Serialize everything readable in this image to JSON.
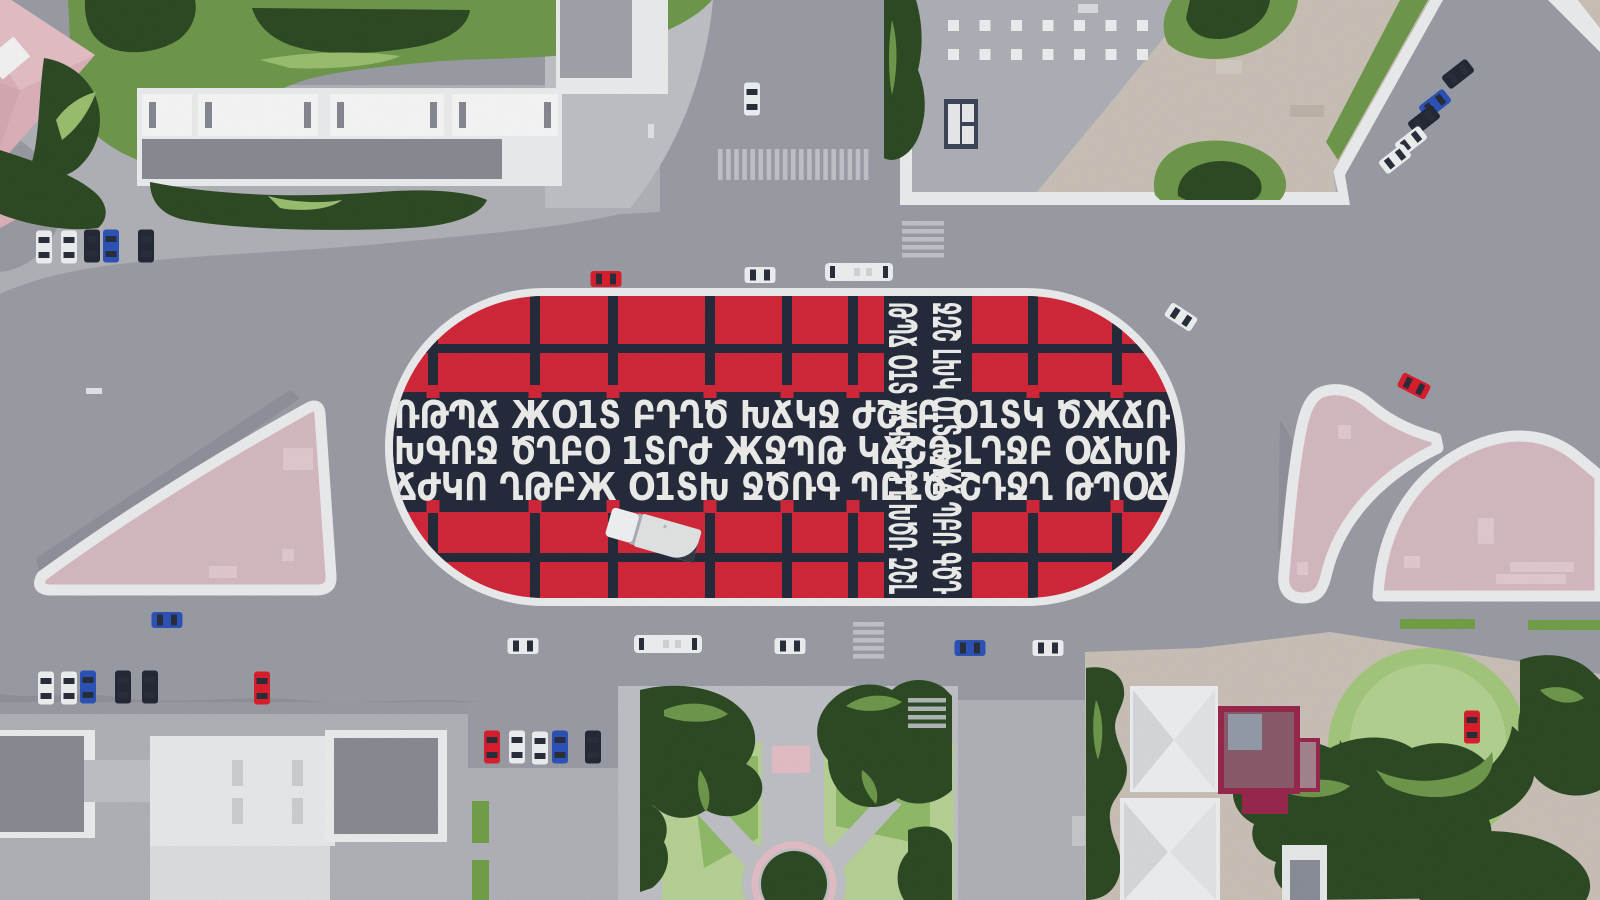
{
  "palette": {
    "road": "#9fa1aa",
    "sidewalk": "#b5b7bd",
    "pave": "#c4c6cb",
    "paveBright": "#dfe1e4",
    "shadow": "#8b8d96",
    "white": "#f2f3f4",
    "whiteBright": "#fafbfb",
    "roofGray": "#8d8f98",
    "roofLightGray": "#b3b5bc",
    "beige": "#cfc6bc",
    "tan": "#c8b9a9",
    "pinkRoof": "#e2b6bf",
    "pinkRoofLight": "#ecc7cd",
    "pinkRoofDark": "#d8a8b2",
    "pinkPlaza": "#dbbfc6",
    "pinkPatch": "#e7d0d5",
    "plazaRed": "#d7293c",
    "plazaNavy": "#272d3e",
    "glyph": "#f4f4f2",
    "greenDark": "#2f4d26",
    "greenMid": "#729c4e",
    "greenLight": "#9ec573",
    "lawn": "#bcd79a",
    "grassStrip": "#76a44c",
    "maroon": "#9c2950",
    "maroonInner": "#8e6370",
    "glassFrame": "#40475a",
    "skylightGray": "#97a0ad",
    "carWhite": "#f5f6f7",
    "carBlack": "#262b39",
    "carBlue": "#2f55bd",
    "carRed": "#e0202e",
    "carWindow": "#2b303d",
    "crosswalk": "#cdcfd4",
    "truckBody": "#e8ebeb",
    "truckCab": "#f7f8f9",
    "truckShadow": "#363b47"
  },
  "plaza": {
    "glyph_rows": [
      "ՌԹՊՃ ЖՕ1Տ ԲԴՂԾ ԽՃԿՋ ԺՇԼԲ Օ1ՏԿ ԾЖՃՌ",
      "ԽԳՌՋ ԾՂԲՕ 1ՏՐԺ ЖՋՊԹ ԿՃՇԶ ԼԴՋԲ ՕՃԽՌ",
      "ՃԺԿՈ ՂԹԲЖ Օ1ՏԽ ՋԾՌԳ ՊԸԼԾ ՇԴՋՂ ԹՊՕՃ"
    ],
    "glyph_cols": [
      "ԹՊՃ Օ1Տ ЖԿՋ ԲԴՂ ԽԾՌ ԶՇԼ",
      "ՋԶՇ ԼԽԿ Օ1Տ ԹЖՃ ՊԲՌ ԳԾԴ"
    ],
    "grid": {
      "left_bars_x": [
        428,
        530,
        608,
        705,
        782,
        848
      ],
      "right_bars_x": [
        1028,
        1112
      ],
      "bar_w": 10,
      "top_y1": 296,
      "top_y2": 392,
      "bottom_y1": 506,
      "bottom_y2": 598,
      "hbar_top_y": 344,
      "hbar_bottom_y": 553,
      "hbar_h": 9,
      "dots_y_top": 385,
      "dots_y_bottom": 500,
      "dot": 13
    }
  },
  "cars": [
    {
      "cx": 44,
      "cy": 247,
      "rot": 0,
      "o": "v",
      "color": "white"
    },
    {
      "cx": 69,
      "cy": 247,
      "rot": 0,
      "o": "v",
      "color": "white"
    },
    {
      "cx": 92,
      "cy": 246,
      "rot": 0,
      "o": "v",
      "color": "black"
    },
    {
      "cx": 111,
      "cy": 246,
      "rot": 0,
      "o": "v",
      "color": "blue"
    },
    {
      "cx": 146,
      "cy": 246,
      "rot": 0,
      "o": "v",
      "color": "black"
    },
    {
      "cx": 752,
      "cy": 99,
      "rot": 0,
      "o": "v",
      "color": "white"
    },
    {
      "cx": 606,
      "cy": 279,
      "rot": 0,
      "o": "h",
      "color": "red"
    },
    {
      "cx": 760,
      "cy": 275,
      "rot": 0,
      "o": "h",
      "color": "white"
    },
    {
      "cx": 859,
      "cy": 272,
      "rot": 0,
      "o": "bus",
      "color": "white"
    },
    {
      "cx": 1181,
      "cy": 317,
      "rot": 33,
      "o": "h",
      "color": "white"
    },
    {
      "cx": 1414,
      "cy": 386,
      "rot": 27,
      "o": "h",
      "color": "red"
    },
    {
      "cx": 1458,
      "cy": 74,
      "rot": -38,
      "o": "h",
      "color": "black"
    },
    {
      "cx": 1435,
      "cy": 104,
      "rot": -38,
      "o": "h",
      "color": "blue"
    },
    {
      "cx": 1424,
      "cy": 120,
      "rot": -38,
      "o": "h",
      "color": "black"
    },
    {
      "cx": 1411,
      "cy": 141,
      "rot": -38,
      "o": "h",
      "color": "white"
    },
    {
      "cx": 1395,
      "cy": 159,
      "rot": -38,
      "o": "h",
      "color": "white"
    },
    {
      "cx": 167,
      "cy": 620,
      "rot": 0,
      "o": "h",
      "color": "blue"
    },
    {
      "cx": 46,
      "cy": 688,
      "rot": 0,
      "o": "v",
      "color": "white"
    },
    {
      "cx": 69,
      "cy": 688,
      "rot": 0,
      "o": "v",
      "color": "white"
    },
    {
      "cx": 88,
      "cy": 687,
      "rot": 0,
      "o": "v",
      "color": "blue"
    },
    {
      "cx": 123,
      "cy": 687,
      "rot": 0,
      "o": "v",
      "color": "black"
    },
    {
      "cx": 150,
      "cy": 687,
      "rot": 0,
      "o": "v",
      "color": "black"
    },
    {
      "cx": 262,
      "cy": 688,
      "rot": 0,
      "o": "v",
      "color": "red"
    },
    {
      "cx": 492,
      "cy": 747,
      "rot": 0,
      "o": "v",
      "color": "red"
    },
    {
      "cx": 517,
      "cy": 747,
      "rot": 0,
      "o": "v",
      "color": "white"
    },
    {
      "cx": 540,
      "cy": 748,
      "rot": 0,
      "o": "v",
      "color": "white"
    },
    {
      "cx": 560,
      "cy": 747,
      "rot": 0,
      "o": "v",
      "color": "blue"
    },
    {
      "cx": 593,
      "cy": 747,
      "rot": 0,
      "o": "v",
      "color": "black"
    },
    {
      "cx": 523,
      "cy": 646,
      "rot": 0,
      "o": "h",
      "color": "white"
    },
    {
      "cx": 668,
      "cy": 644,
      "rot": 0,
      "o": "bus",
      "color": "white"
    },
    {
      "cx": 790,
      "cy": 646,
      "rot": 0,
      "o": "h",
      "color": "white"
    },
    {
      "cx": 970,
      "cy": 648,
      "rot": 0,
      "o": "h",
      "color": "blue"
    },
    {
      "cx": 1048,
      "cy": 648,
      "rot": 0,
      "o": "h",
      "color": "white"
    },
    {
      "cx": 1472,
      "cy": 727,
      "rot": 0,
      "o": "v",
      "color": "red"
    }
  ],
  "crosswalks": [
    {
      "x": 718,
      "y": 149,
      "dir": "v",
      "count": 19,
      "sw": 4.6,
      "gap": 3.5,
      "len": 31
    },
    {
      "x": 902,
      "y": 221,
      "dir": "h",
      "count": 5,
      "sw": 4.5,
      "gap": 3.5,
      "len": 42
    },
    {
      "x": 853,
      "y": 622,
      "dir": "h",
      "count": 5,
      "sw": 4.5,
      "gap": 3.5,
      "len": 31
    },
    {
      "x": 908,
      "y": 698,
      "dir": "h",
      "count": 4,
      "sw": 4.5,
      "gap": 4,
      "len": 38
    }
  ],
  "grass_strips": [
    {
      "x": 472,
      "y": 801,
      "w": 17,
      "h": 42
    },
    {
      "x": 472,
      "y": 860,
      "w": 17,
      "h": 40
    },
    {
      "x": 1400,
      "y": 619,
      "w": 75,
      "h": 10
    },
    {
      "x": 1528,
      "y": 620,
      "w": 72,
      "h": 10
    }
  ],
  "lane_dashes": [
    {
      "x": 86,
      "y": 388,
      "w": 16,
      "h": 6
    },
    {
      "x": 648,
      "y": 124,
      "w": 6,
      "h": 14
    }
  ],
  "roof_skylights": {
    "x0": 948,
    "step": 31.5,
    "size": 11,
    "rows": [
      {
        "y": 20,
        "count": 8
      },
      {
        "y": 49,
        "count": 7
      }
    ]
  }
}
